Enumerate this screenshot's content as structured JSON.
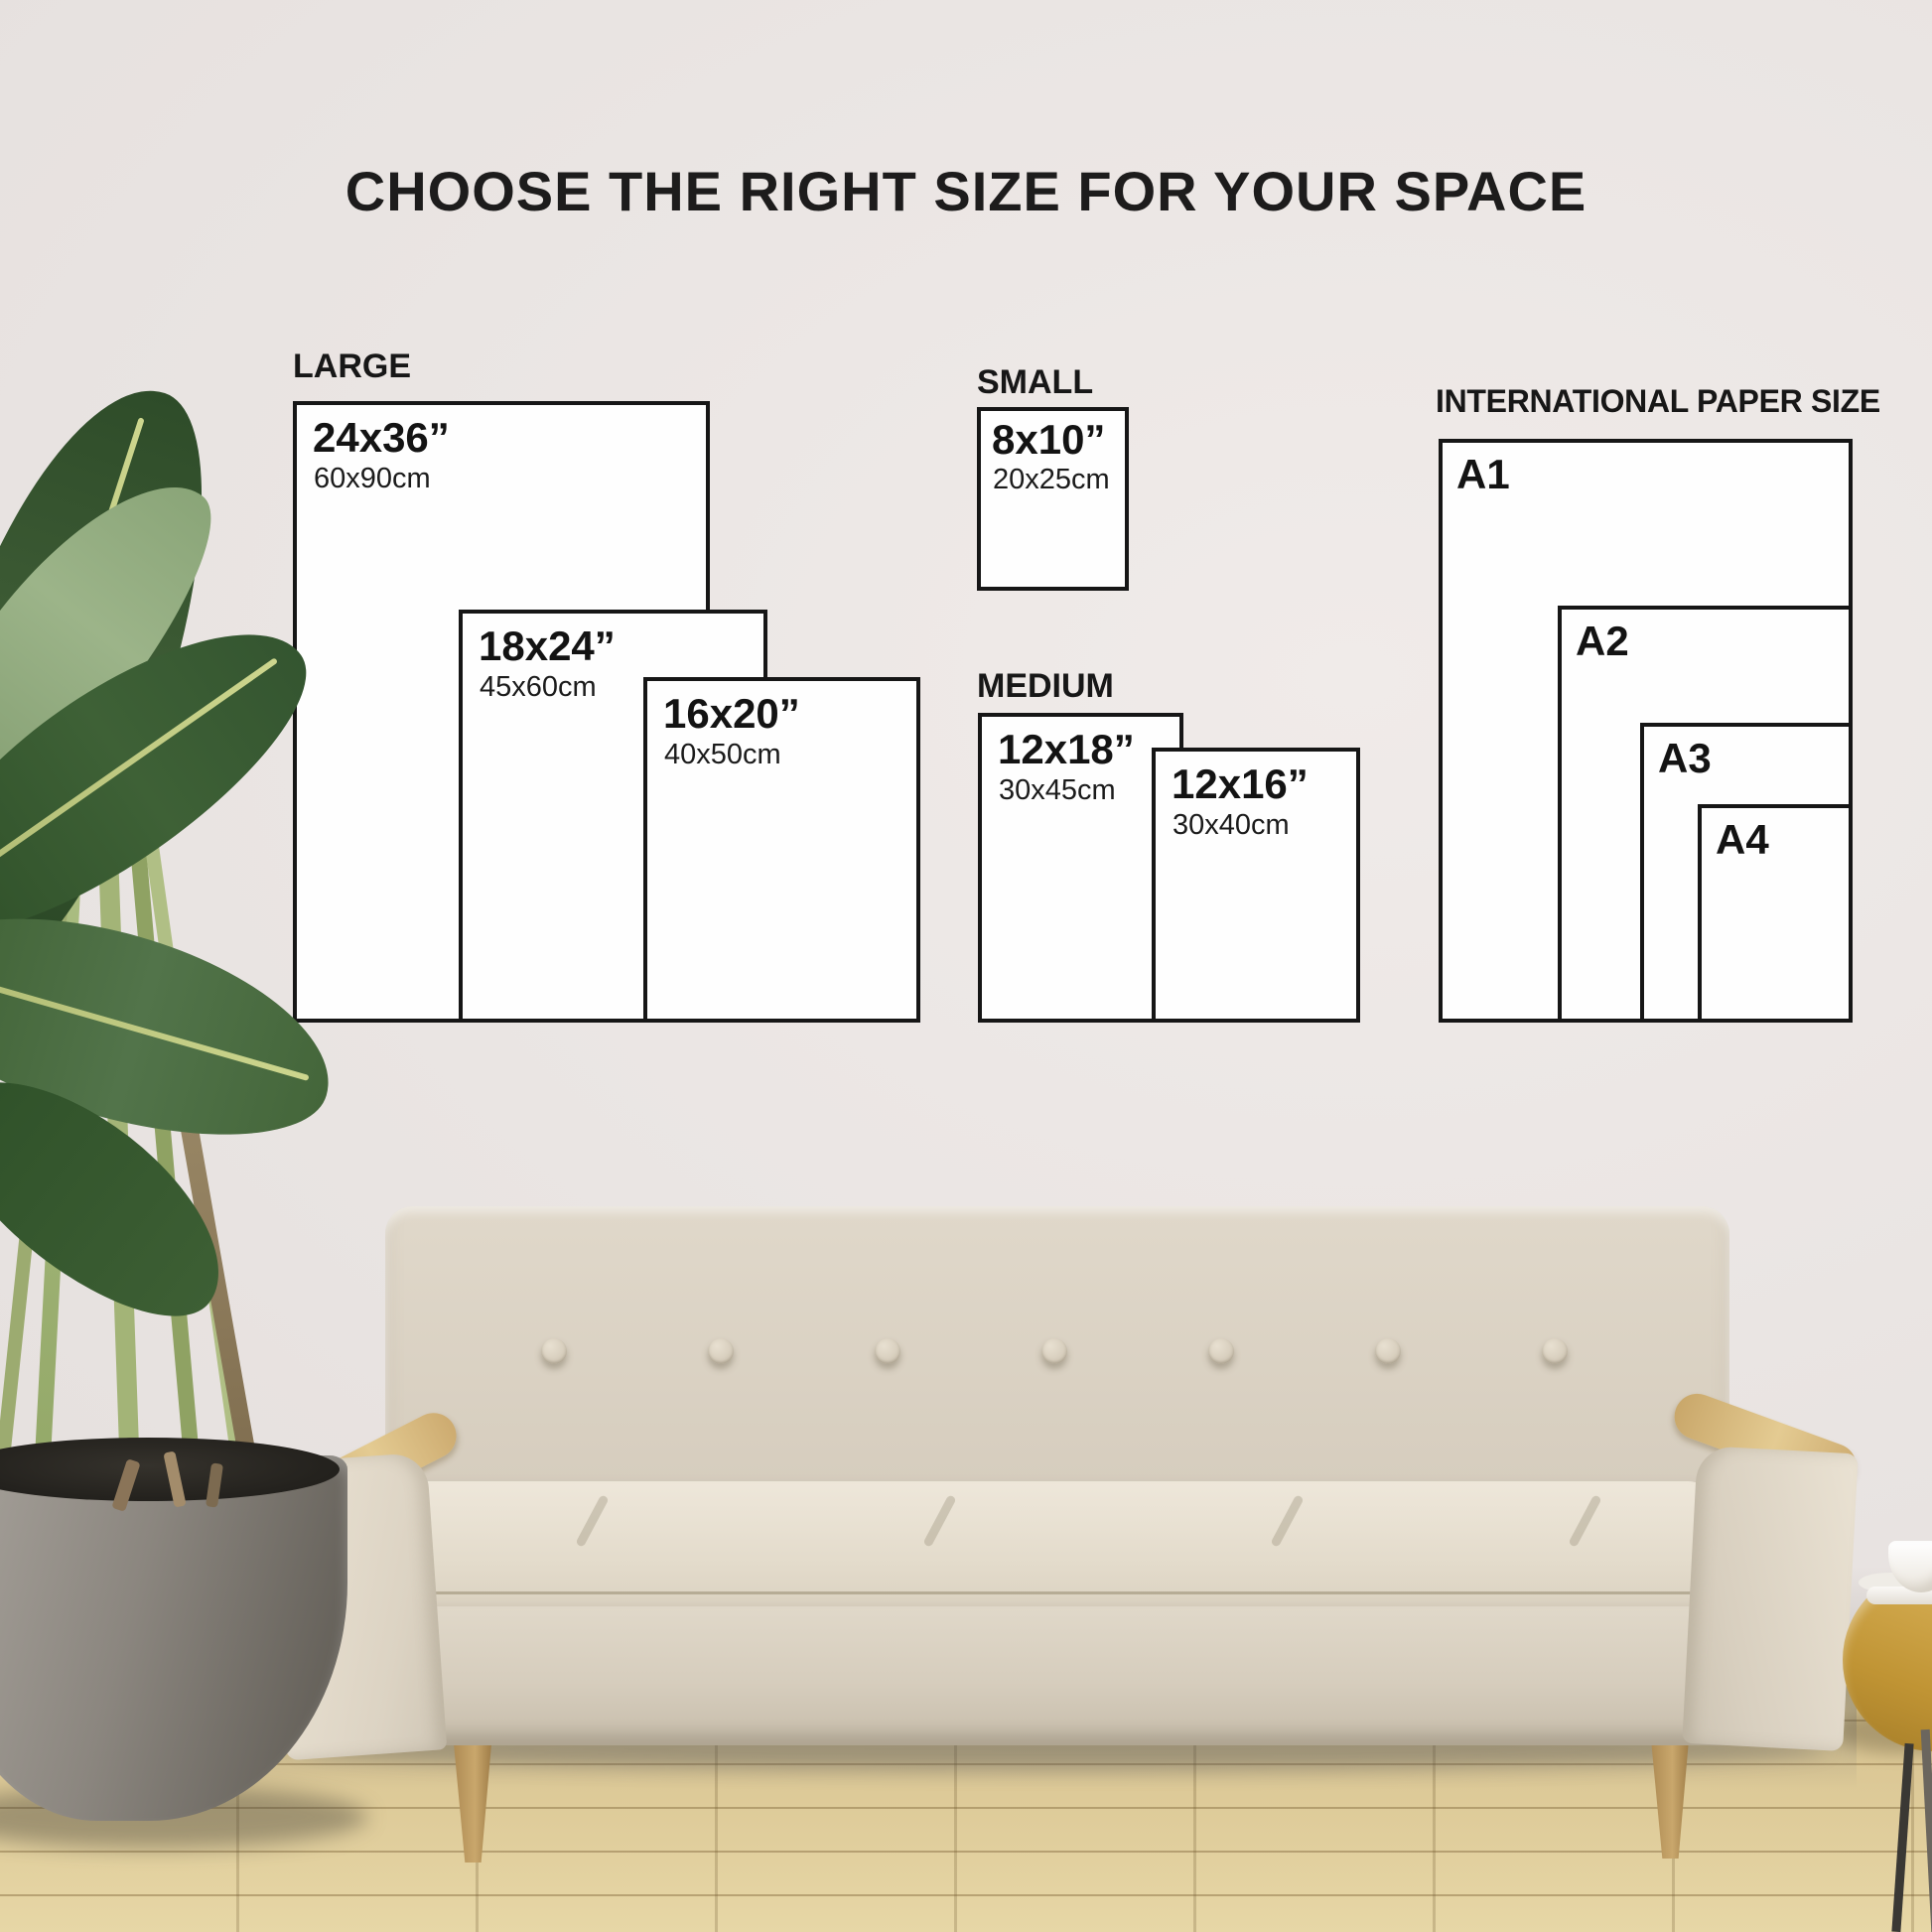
{
  "title": "CHOOSE THE RIGHT SIZE FOR YOUR SPACE",
  "groups": {
    "large": {
      "label": "LARGE",
      "sizes": [
        {
          "inch": "24x36”",
          "cm": "60x90cm"
        },
        {
          "inch": "18x24”",
          "cm": "45x60cm"
        },
        {
          "inch": "16x20”",
          "cm": "40x50cm"
        }
      ]
    },
    "small": {
      "label": "SMALL",
      "sizes": [
        {
          "inch": "8x10”",
          "cm": "20x25cm"
        }
      ]
    },
    "medium": {
      "label": "MEDIUM",
      "sizes": [
        {
          "inch": "12x18”",
          "cm": "30x45cm"
        },
        {
          "inch": "12x16”",
          "cm": "30x40cm"
        }
      ]
    },
    "international": {
      "label": "INTERNATIONAL PAPER SIZE",
      "sizes": [
        {
          "name": "A1"
        },
        {
          "name": "A2"
        },
        {
          "name": "A3"
        },
        {
          "name": "A4"
        }
      ]
    }
  },
  "colors": {
    "ink": "#161616",
    "paper": "#fefefe",
    "wall": "#e9e4e2",
    "floor_wood": "#dbc795",
    "sofa_fabric": "#dcd4c5",
    "armrest_wood": "#d6b47a",
    "leaf_green": "#3c5a33"
  }
}
